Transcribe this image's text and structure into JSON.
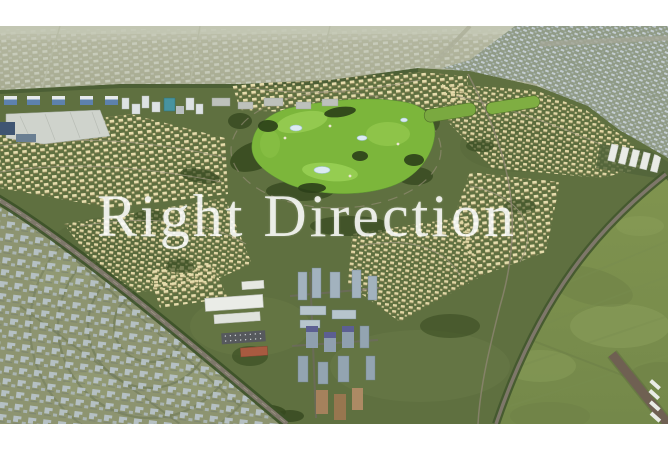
{
  "page": {
    "background_color": "#ffffff",
    "width": 668,
    "height": 452
  },
  "photo": {
    "type": "aerial-3d-render",
    "description": "Aerial master-plan render of a residential community with a central golf course, dense city districts behind, an older gray-roofed district at lower left, an office-tower cluster at bottom center and a large empty green field at lower right",
    "top_margin_px": 26,
    "bottom_margin_px": 28,
    "watermark": {
      "text": "Right Direction",
      "style": "translucent white serif",
      "color": "rgba(255,255,255,0.84)"
    },
    "palette": {
      "distant_city_base": "#a8ab93",
      "distant_city_buildings": "#ccd0c2",
      "far_city_blue_base": "#909b86",
      "far_city_blue_buildings": "#c9d3db",
      "development_ground": "#5f7040",
      "villa_beige": "#e6dcac",
      "golf_green": "#7cb63b",
      "tree_dark_green": "#33471f",
      "lake_blue": "#dcebf2",
      "old_district_ground": "#8d9470",
      "old_district_houses": "#b7c2c7",
      "office_tower_glass": "#a2b2be",
      "tower_roof_purple": "#5c5f92",
      "field_green": "#7e914f",
      "road_gray": "#7e776a",
      "road_brown": "#6f6052",
      "campus_white": "#eaece7",
      "red_roof": "#a85a40"
    }
  }
}
